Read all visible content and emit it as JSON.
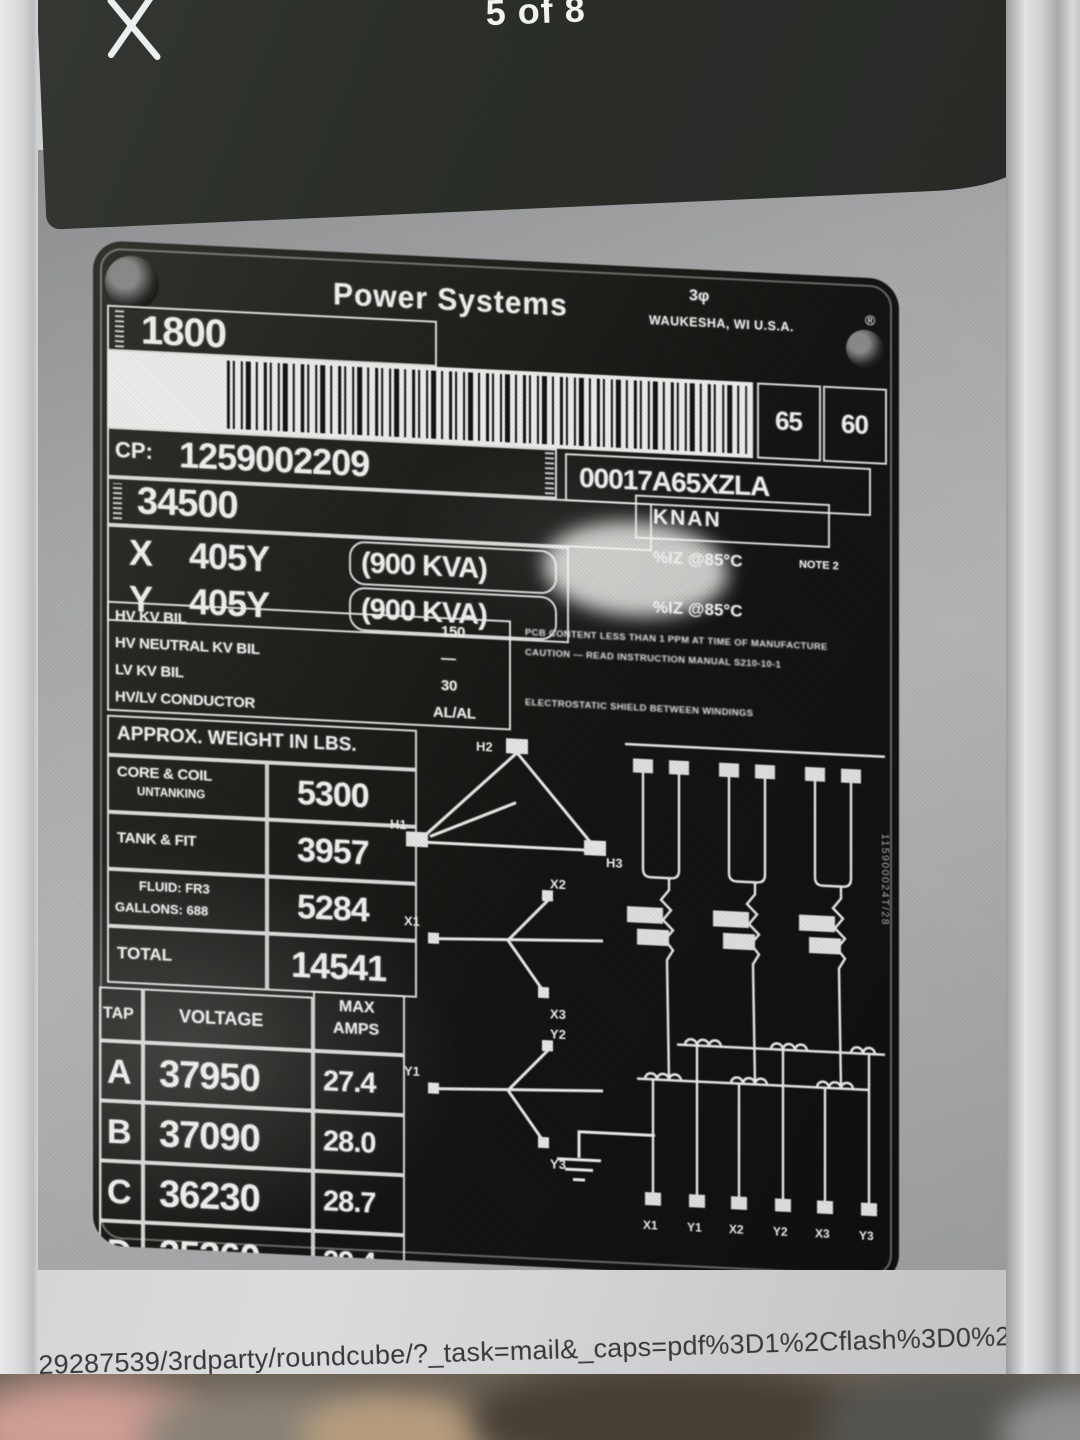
{
  "viewer": {
    "counter": "5 of 8"
  },
  "plate": {
    "brand": "Power Systems",
    "phase": "3φ",
    "factory": "WAUKESHA, WI U.S.A.",
    "mark": "®",
    "class_value": "1800",
    "temp_rise": "65",
    "frequency": "60",
    "serial_label": "CP:",
    "serial": "1259002209",
    "catalog": "00017A65XZLA",
    "hv_voltage": "34500",
    "cooling_class": "KNAN",
    "ratings": [
      {
        "winding": "X",
        "voltage": "405Y",
        "kva": "(900 KVA)"
      },
      {
        "winding": "Y",
        "voltage": "405Y",
        "kva": "(900 KVA)"
      }
    ],
    "impedance": {
      "line1": "%IZ @85°C",
      "note": "NOTE 2",
      "line2": "%IZ @85°C"
    },
    "bil_rows": [
      {
        "label": "HV KV BIL",
        "value": "150"
      },
      {
        "label": "HV NEUTRAL KV BIL",
        "value": "—"
      },
      {
        "label": "LV KV BIL",
        "value": "30"
      },
      {
        "label": "HV/LV CONDUCTOR",
        "value": "AL/AL"
      }
    ],
    "notices": {
      "pcb": "PCB CONTENT LESS THAN 1 PPM AT TIME OF MANUFACTURE",
      "caution": "CAUTION — READ INSTRUCTION MANUAL S210-10-1",
      "shield": "ELECTROSTATIC SHIELD BETWEEN WINDINGS"
    },
    "weights": {
      "title": "APPROX. WEIGHT IN LBS.",
      "rows": [
        {
          "label": "CORE & COIL",
          "sub": "UNTANKING",
          "value": "5300"
        },
        {
          "label": "TANK & FIT",
          "sub": "",
          "value": "3957"
        },
        {
          "label": "FLUID: FR3",
          "sub": "GALLONS: 688",
          "value": "5284"
        },
        {
          "label": "TOTAL",
          "sub": "",
          "value": "14541"
        }
      ]
    },
    "taps": {
      "h_tap": "TAP",
      "h_voltage": "VOLTAGE",
      "h_max": "MAX",
      "h_amps": "AMPS",
      "rows": [
        {
          "tap": "A",
          "voltage": "37950",
          "amps": "27.4"
        },
        {
          "tap": "B",
          "voltage": "37090",
          "amps": "28.0"
        },
        {
          "tap": "C",
          "voltage": "36230",
          "amps": "28.7"
        },
        {
          "tap": "D",
          "voltage": "35360",
          "amps": "29.4"
        }
      ]
    },
    "phasors": {
      "delta": {
        "top": "H2",
        "left": "H1",
        "right": "H3"
      },
      "wye_x": {
        "top": "X2",
        "left": "X1",
        "bottom": "X3"
      },
      "wye_y": {
        "top": "Y2",
        "left": "Y1",
        "bottom": "Y3"
      }
    },
    "terminals": [
      "X1",
      "Y1",
      "X2",
      "Y2",
      "X3",
      "Y3"
    ],
    "side_code": "115900024T/28"
  },
  "url_line": "s0629287539/3rdparty/roundcube/?_task=mail&_caps=pdf%3D1%2Cflash%3D0%2Ctiff%3D0%2Cwebp%3"
}
